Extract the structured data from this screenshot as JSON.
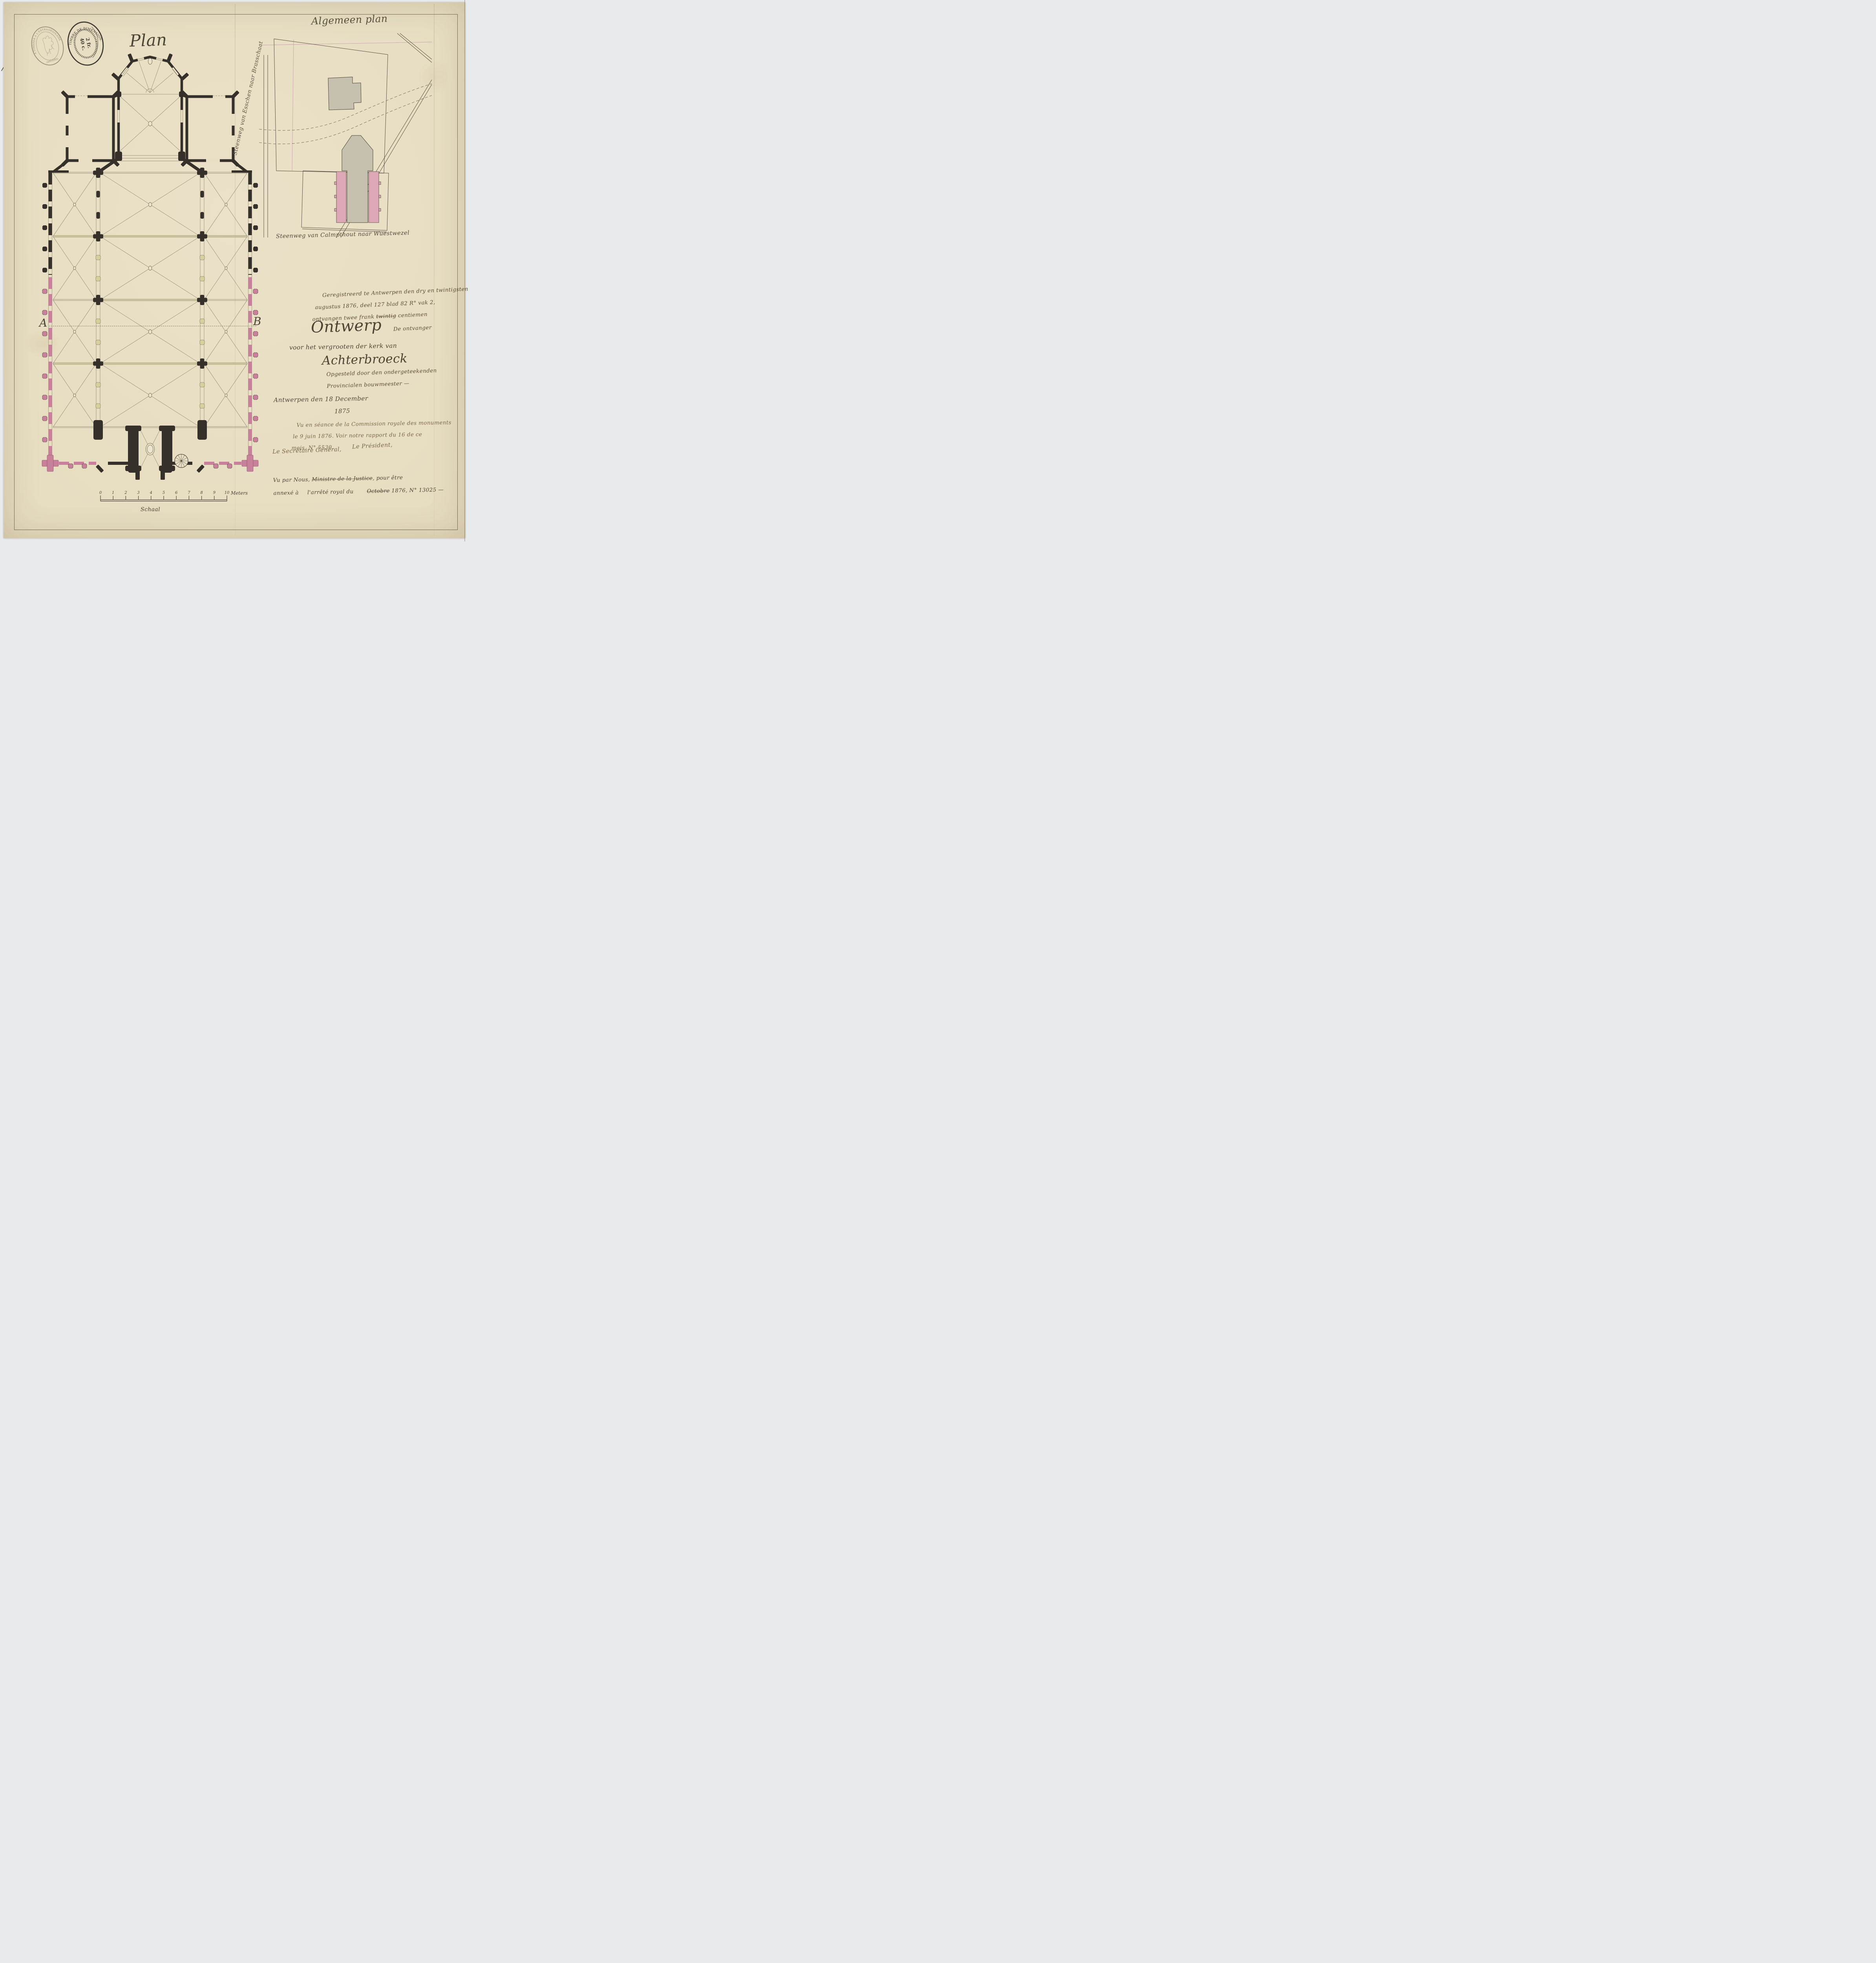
{
  "document": {
    "plan_title": "Plan",
    "section_label_a": "A",
    "section_label_b": "B"
  },
  "stamps": {
    "extraordinary": {
      "legend": "A TIMBRER À L'EXTRAORDINAIRE",
      "bottom": "(ANVERS)"
    },
    "dimension": {
      "legend": "TIMBRE DE DIMENSION.",
      "value_top": "2 fr.",
      "value_bottom": "40 c."
    }
  },
  "site_plan": {
    "title": "Algemeen plan",
    "road_west": "Steenweg van Esschen naar Brasschaat",
    "road_south": "Steenweg van Calmpthout naar Wuestwezel"
  },
  "registration_note": {
    "line1": "Geregistreerd te Antwerpen den dry en twintigsten",
    "line2": "augustus 1876, deel 127 blad 82 R° vak 2,",
    "line3a": "ontvangen twee frank ",
    "line3_struck": "twintig",
    "line3b": " centiemen",
    "signoff": "De ontvanger"
  },
  "title_block": {
    "line1": "Ontwerp",
    "line2": "voor het vergrooten der kerk van",
    "line3": "Achterbroeck"
  },
  "author_note": {
    "line1": "Opgesteld door den ondergeteekenden",
    "line2": "Provincialen bouwmeester —"
  },
  "date_note": {
    "line1": "Antwerpen den 18 December",
    "line2": "1875"
  },
  "commission_note": {
    "line1": "Vu en séance de la Commission royale des monuments",
    "line2": "le 9 juin 1876. Voir notre rapport du 16 de ce",
    "line3": "mois, N° 5530."
  },
  "officials": {
    "secretary": "Le Secrétaire Général,",
    "president": "Le Président,"
  },
  "minister_note": {
    "line1a": "Vu par Nous, ",
    "line1b": "Ministre de la Justice",
    "line1c": ", pour être",
    "line2a": "annexé à",
    "line2b": "l'arrêté royal du",
    "line2c": "Octobre",
    "line2d": " 1876, N° 13025 —"
  },
  "scale_bar": {
    "numbers": [
      "0",
      "1",
      "2",
      "3",
      "4",
      "5",
      "6",
      "7",
      "8",
      "9",
      "10"
    ],
    "unit": "Meters",
    "label": "Schaal"
  },
  "colors": {
    "paper": "#e8dfc5",
    "ink": "#4a4335",
    "existing_wall_black": "#35312a",
    "new_wall_pink": "#c9809a",
    "old_column_yellow": "#d8d09c",
    "building_grey": "#c6c0ae",
    "red_pencil": "#c4574a"
  }
}
